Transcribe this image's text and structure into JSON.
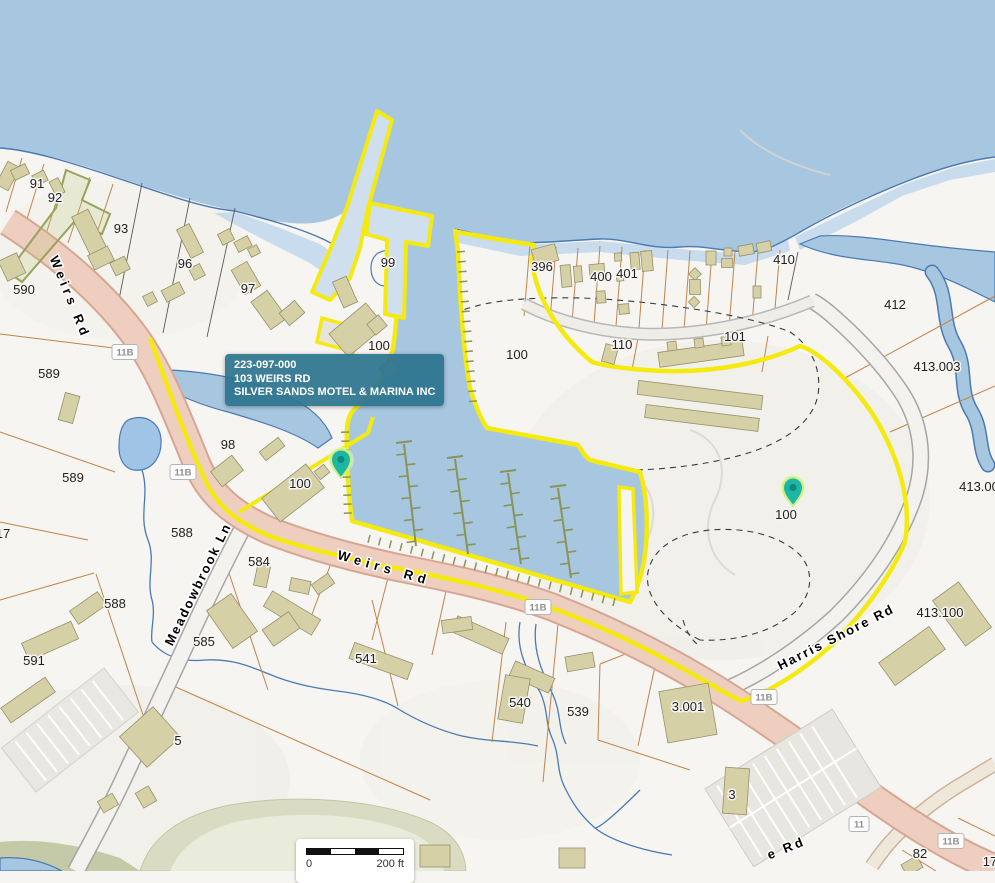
{
  "tooltip": {
    "parcel_id": "223-097-000",
    "address": "103 WEIRS RD",
    "owner": "SILVER SANDS MOTEL & MARINA INC"
  },
  "scale_bar": {
    "start": "0",
    "end": "200 ft"
  },
  "map": {
    "colors": {
      "water": "#a7c6e0",
      "shallow_water": "#c8dcee",
      "shoreline": "#4a7ab3",
      "land": "#f7f5f1",
      "highlight": "#f5ea10",
      "road_major": "#eecebf",
      "road_minor": "#f4f2ee",
      "building": "#d6d0a6",
      "parcel_line": "#c08449",
      "tooltip_bg": "#2c748f",
      "pin": "#1db6a5"
    },
    "parcel_labels": [
      {
        "t": "91",
        "x": 37,
        "y": 188
      },
      {
        "t": "92",
        "x": 55,
        "y": 202
      },
      {
        "t": "93",
        "x": 121,
        "y": 233
      },
      {
        "t": "96",
        "x": 185,
        "y": 268
      },
      {
        "t": "97",
        "x": 248,
        "y": 293
      },
      {
        "t": "590",
        "x": 24,
        "y": 294
      },
      {
        "t": "589",
        "x": 49,
        "y": 378
      },
      {
        "t": "589",
        "x": 73,
        "y": 482
      },
      {
        "t": "17",
        "x": 3,
        "y": 538
      },
      {
        "t": "588",
        "x": 182,
        "y": 537
      },
      {
        "t": "588",
        "x": 115,
        "y": 608
      },
      {
        "t": "584",
        "x": 259,
        "y": 566
      },
      {
        "t": "585",
        "x": 204,
        "y": 646
      },
      {
        "t": "541",
        "x": 366,
        "y": 663
      },
      {
        "t": "591",
        "x": 34,
        "y": 665
      },
      {
        "t": "5",
        "x": 178,
        "y": 745
      },
      {
        "t": "540",
        "x": 520,
        "y": 707
      },
      {
        "t": "539",
        "x": 578,
        "y": 716
      },
      {
        "t": "99",
        "x": 388,
        "y": 267
      },
      {
        "t": "100",
        "x": 379,
        "y": 350
      },
      {
        "t": "100",
        "x": 300,
        "y": 488
      },
      {
        "t": "100",
        "x": 517,
        "y": 359
      },
      {
        "t": "100",
        "x": 786,
        "y": 519
      },
      {
        "t": "98",
        "x": 228,
        "y": 449
      },
      {
        "t": "396",
        "x": 542,
        "y": 271
      },
      {
        "t": "400",
        "x": 601,
        "y": 281
      },
      {
        "t": "401",
        "x": 627,
        "y": 278
      },
      {
        "t": "410",
        "x": 784,
        "y": 264
      },
      {
        "t": "412",
        "x": 895,
        "y": 309
      },
      {
        "t": "413.003",
        "x": 937,
        "y": 371
      },
      {
        "t": "413.00",
        "x": 979,
        "y": 491
      },
      {
        "t": "413.100",
        "x": 940,
        "y": 617
      },
      {
        "t": "110",
        "x": 622,
        "y": 349
      },
      {
        "t": "101",
        "x": 735,
        "y": 341
      },
      {
        "t": "3.001",
        "x": 688,
        "y": 711
      },
      {
        "t": "3",
        "x": 732,
        "y": 799
      },
      {
        "t": "82",
        "x": 920,
        "y": 858
      },
      {
        "t": "17",
        "x": 990,
        "y": 866
      }
    ],
    "road_labels": [
      {
        "t": "Weirs Rd",
        "x": 66,
        "y": 299,
        "a": 68,
        "ls": 4
      },
      {
        "t": "Weirs Rd",
        "x": 383,
        "y": 572,
        "a": 16,
        "ls": 5
      },
      {
        "t": "Meadowbrook Ln",
        "x": 202,
        "y": 586,
        "a": -64,
        "ls": 2
      },
      {
        "t": "Harris Shore Rd",
        "x": 838,
        "y": 641,
        "a": -27,
        "ls": 2
      },
      {
        "t": "e Rd",
        "x": 788,
        "y": 852,
        "a": -22,
        "ls": 3
      }
    ],
    "route_shields": [
      {
        "t": "11B",
        "x": 125,
        "y": 352
      },
      {
        "t": "11B",
        "x": 183,
        "y": 472
      },
      {
        "t": "11B",
        "x": 538,
        "y": 607
      },
      {
        "t": "11B",
        "x": 764,
        "y": 697
      },
      {
        "t": "11",
        "x": 859,
        "y": 824
      },
      {
        "t": "11B",
        "x": 951,
        "y": 841
      }
    ],
    "pins": [
      {
        "x": 341,
        "y": 469
      },
      {
        "x": 793,
        "y": 497
      }
    ]
  }
}
